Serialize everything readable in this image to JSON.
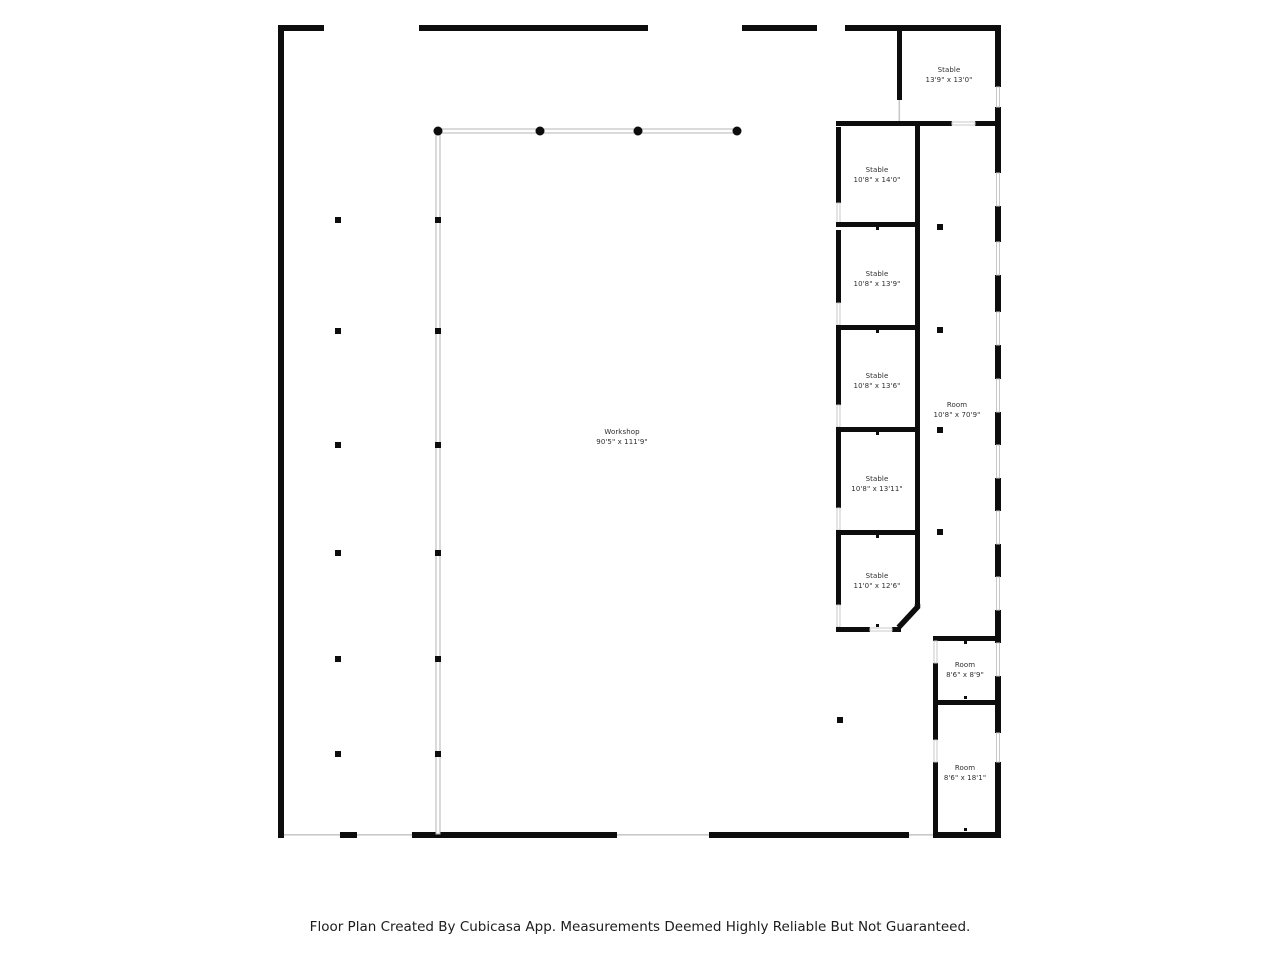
{
  "colors": {
    "wall": "#0d0d0d",
    "thin_wall": "#b5b5b5",
    "opening": "#c9c9c9",
    "background": "#ffffff",
    "label_text": "#2e2e2e",
    "caption_text": "#1c1c1c"
  },
  "rooms": [
    {
      "id": "stable-top-right",
      "name": "Stable",
      "dimensions": "13'9\" x 13'0\""
    },
    {
      "id": "stable-1",
      "name": "Stable",
      "dimensions": "10'8\" x 14'0\""
    },
    {
      "id": "stable-2",
      "name": "Stable",
      "dimensions": "10'8\" x 13'9\""
    },
    {
      "id": "stable-3",
      "name": "Stable",
      "dimensions": "10'8\" x 13'6\""
    },
    {
      "id": "stable-4",
      "name": "Stable",
      "dimensions": "10'8\" x 13'11\""
    },
    {
      "id": "stable-5",
      "name": "Stable",
      "dimensions": "11'0\" x 12'6\""
    },
    {
      "id": "room-right",
      "name": "Room",
      "dimensions": "10'8\" x 70'9\""
    },
    {
      "id": "workshop",
      "name": "Workshop",
      "dimensions": "90'5\" x 111'9\""
    },
    {
      "id": "room-small",
      "name": "Room",
      "dimensions": "8'6\" x 8'9\""
    },
    {
      "id": "room-long",
      "name": "Room",
      "dimensions": "8'6\" x 18'1\""
    }
  ],
  "caption": "Floor Plan Created By Cubicasa App. Measurements Deemed Highly Reliable But Not Guaranteed."
}
